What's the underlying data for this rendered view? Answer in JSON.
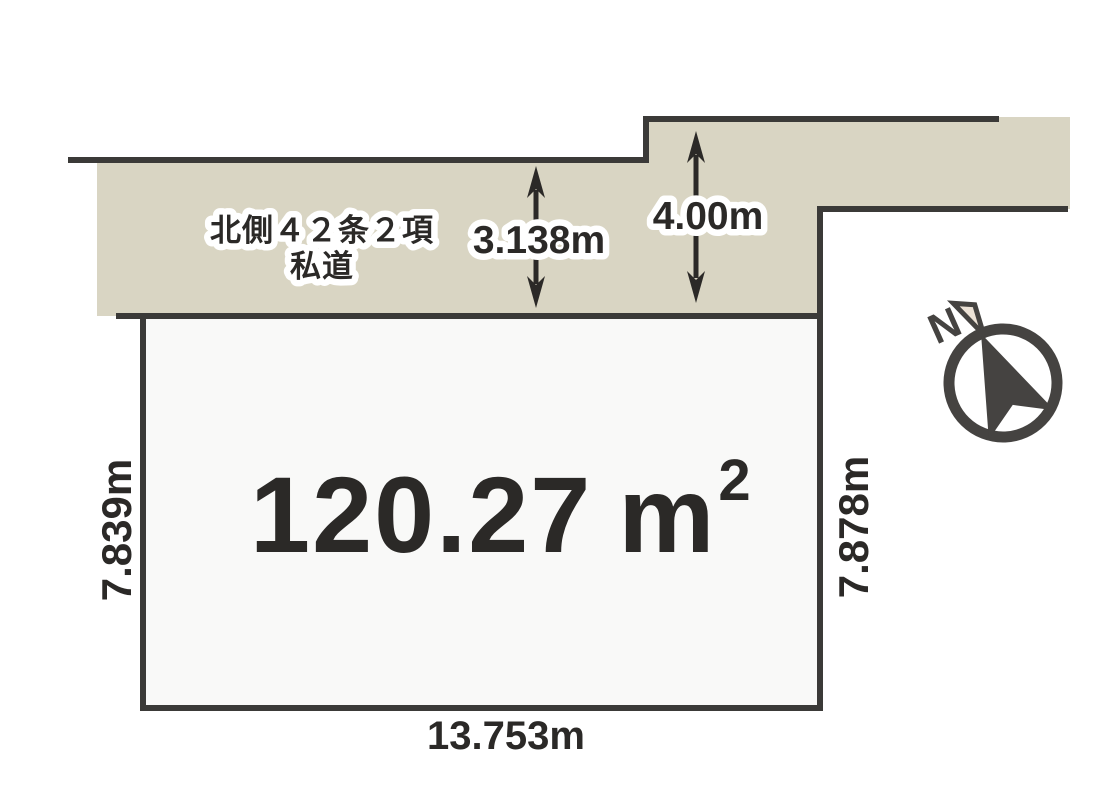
{
  "diagram": {
    "type": "land-plot-survey-diagram",
    "plot": {
      "area_value": "120.27",
      "area_unit": "m",
      "area_exponent": "2",
      "left_dimension": "7.839m",
      "right_dimension": "7.878m",
      "bottom_dimension": "13.753m"
    },
    "road": {
      "label_line1": "北側４２条２項",
      "label_line2": "私道",
      "width_left": "3.138m",
      "width_right": "4.00m"
    },
    "compass": {
      "north_label": "N"
    },
    "colors": {
      "background": "#ffffff",
      "road_fill": "#d9d5c3",
      "plot_fill": "#f9f9f8",
      "line": "#3b3a38",
      "text": "#2b2927",
      "halo": "#ffffff",
      "compass": "#454341",
      "needle_tip_fill": "#ece2d6"
    }
  }
}
